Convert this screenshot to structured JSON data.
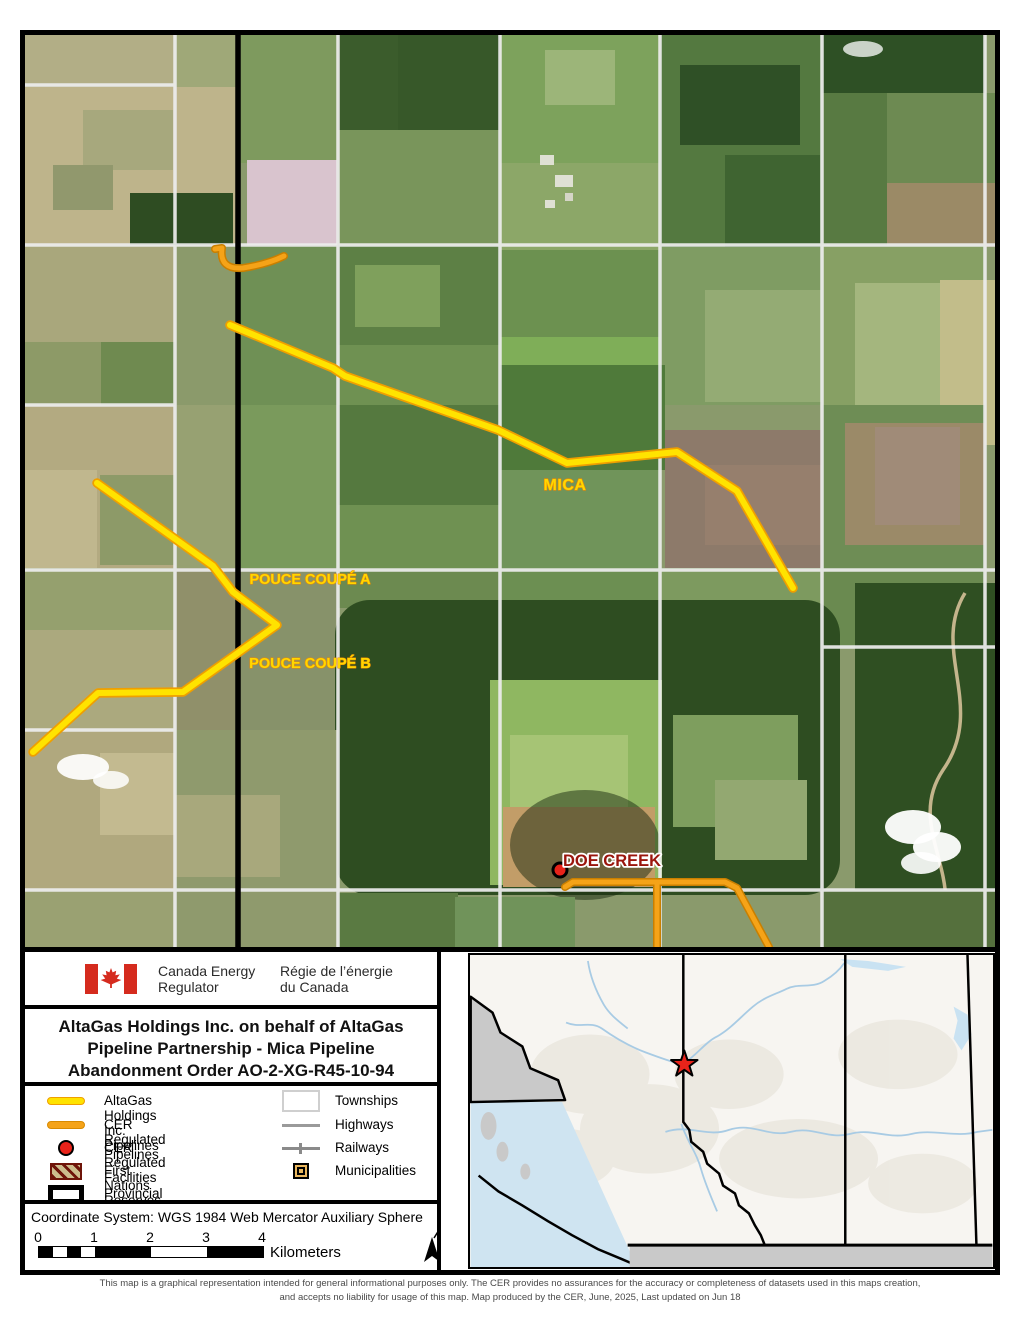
{
  "logo": {
    "agency_en": "Canada Energy\nRegulator",
    "agency_fr": "Régie de l’énergie\ndu Canada"
  },
  "title": {
    "line1": "AltaGas Holdings Inc. on behalf of AltaGas",
    "line2": "Pipeline Partnership - Mica Pipeline",
    "line3": "Abandonment Order AO-2-XG-R45-10-94"
  },
  "legend": {
    "left": [
      {
        "label": "AltaGas Holdings Inc. Pipelines",
        "symbol": "yellow-line"
      },
      {
        "label": "CER Regulated Pipelines",
        "symbol": "orange-line"
      },
      {
        "label": "CER Regulated Facilities",
        "symbol": "red-dot"
      },
      {
        "label": "First Nations Reserves",
        "symbol": "hatched-box"
      },
      {
        "label": "Provincial Boundaries",
        "symbol": "black-outline-box"
      }
    ],
    "right": [
      {
        "label": "Townships",
        "symbol": "white-box"
      },
      {
        "label": "Highways",
        "symbol": "gray-line"
      },
      {
        "label": "Railways",
        "symbol": "railway-line"
      },
      {
        "label": "Municipalities",
        "symbol": "municipality-square"
      }
    ]
  },
  "coordinate_system": "Coordinate System: WGS 1984 Web Mercator Auxiliary Sphere",
  "scale_bar": {
    "ticks": [
      "0",
      "1",
      "2",
      "3",
      "4"
    ],
    "unit": "Kilometers"
  },
  "map_labels": {
    "mica": "MICA",
    "pouce_a": "POUCE COUPÉ A",
    "pouce_b": "POUCE COUPÉ B",
    "doe_creek": "DOE CREEK"
  },
  "footer": {
    "line1": "This map is a graphical representation intended for general informational purposes only. The CER provides no assurances for the accuracy or completeness of datasets used in this maps creation,",
    "line2": "and accepts no liability for usage of this map. Map produced by the CER, June, 2025, Last updated on Jun 18"
  },
  "colors": {
    "pipeline_yellow": "#ffe300",
    "pipeline_orange": "#f5a318",
    "facility_red": "#e8231a",
    "label_dark_red": "#9b150d",
    "flag_red": "#d52b1e",
    "township_grid": "#ededed",
    "provincial_boundary": "#000000",
    "inset_star_red": "#e8231a"
  }
}
